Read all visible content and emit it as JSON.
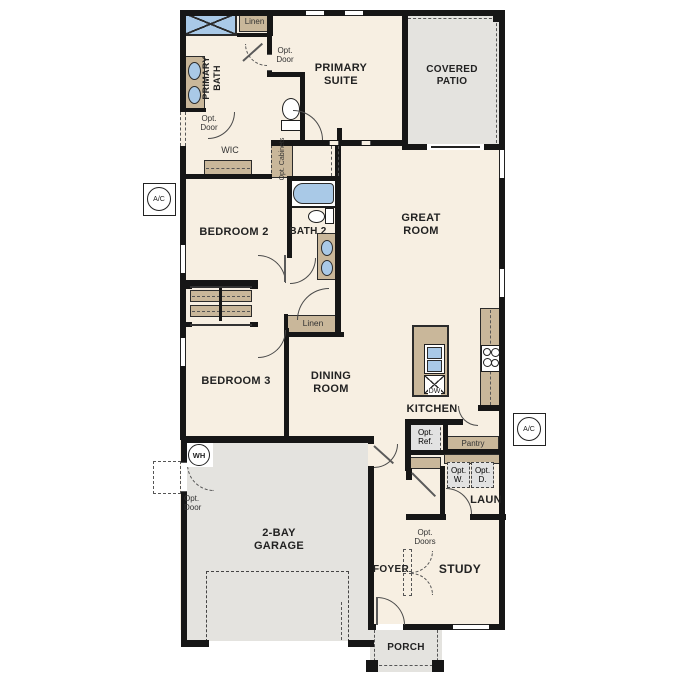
{
  "rooms": {
    "primary_suite": "PRIMARY SUITE",
    "primary_bath": "PRIMARY BATH",
    "covered_patio": "COVERED PATIO",
    "wic": "WIC",
    "linen": "Linen",
    "bedroom2": "BEDROOM 2",
    "bath2": "BATH 2",
    "great_room": "GREAT ROOM",
    "bedroom3": "BEDROOM 3",
    "dining_room": "DINING ROOM",
    "kitchen": "KITCHEN",
    "pantry": "Pantry",
    "laundry": "LAUN",
    "foyer": "FOYER",
    "study": "STUDY",
    "garage": "2-BAY GARAGE",
    "porch": "PORCH"
  },
  "options": {
    "opt_door": "Opt. Door",
    "opt_doors": "Opt. Doors",
    "opt_cabinets": "Opt. Cabinets",
    "opt_ref": "Opt. Ref.",
    "opt_washer": "Opt. W.",
    "opt_dryer": "Opt. D."
  },
  "equipment": {
    "air_conditioner": "A/C",
    "water_heater": "WH",
    "dishwasher": "DW"
  },
  "colors": {
    "floor": "#f7efe2",
    "outdoor": "#e4e3df",
    "wall": "#161616",
    "fixture_tan": "#c9b79a",
    "fixture_blue": "#a9c9e7",
    "optional_fill": "#e2e2e2",
    "text": "#222222"
  }
}
